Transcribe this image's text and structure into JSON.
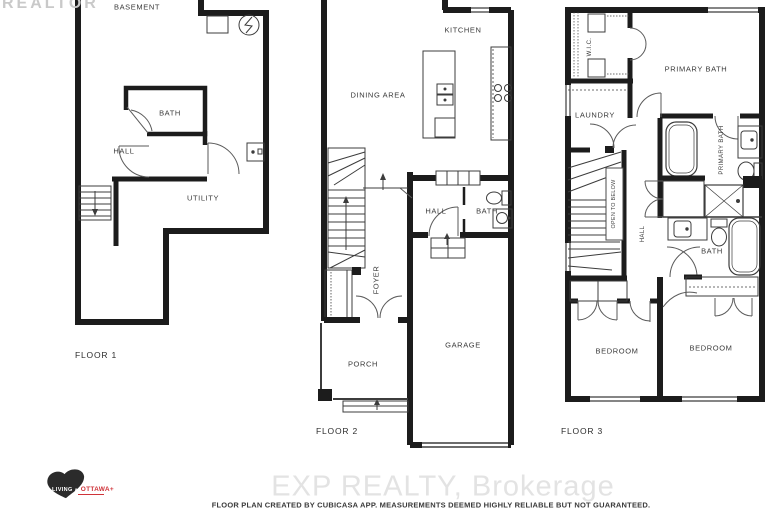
{
  "watermark": "REALTOR",
  "floor1": {
    "title": "FLOOR 1",
    "basement": "BASEMENT",
    "bath": "BATH",
    "hall": "HALL",
    "utility": "UTILITY"
  },
  "floor2": {
    "title": "FLOOR 2",
    "kitchen": "KITCHEN",
    "dining_area": "DINING AREA",
    "hall": "HALL",
    "bath": "BATH",
    "foyer": "FOYER",
    "porch": "PORCH",
    "garage": "GARAGE"
  },
  "floor3": {
    "title": "FLOOR 3",
    "wic": "W.I.C.",
    "primary_bath": "PRIMARY BATH",
    "laundry": "LAUNDRY",
    "open_to_below": "OPEN TO BELOW",
    "hall": "HALL",
    "primary_bath_vertical": "PRIMARY BATH",
    "bath": "BATH",
    "bedroom_left": "BEDROOM",
    "bedroom_right": "BEDROOM"
  },
  "footer": {
    "brokerage": "EXP REALTY, Brokerage",
    "disclaimer": "FLOOR PLAN CREATED BY CUBICASA APP. MEASUREMENTS DEEMED HIGHLY RELIABLE BUT NOT GUARANTEED."
  },
  "logo": {
    "living": "LIVING",
    "in": "IN",
    "ottawa": "OTTAWA+"
  },
  "colors": {
    "wall": "#1c1c1c",
    "label": "#3a3a3a",
    "watermark": "#c9c9c9",
    "brokerage": "#e3e3e3",
    "logo_red": "#cf3339"
  }
}
